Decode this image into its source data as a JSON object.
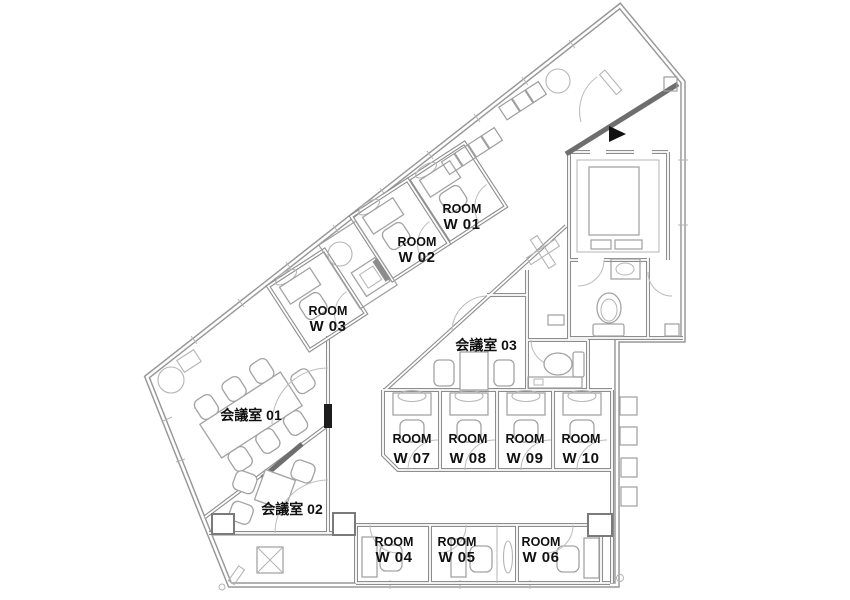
{
  "floorplan": {
    "rooms": [
      {
        "id": "W01",
        "line1": "ROOM",
        "line2": "W 01"
      },
      {
        "id": "W02",
        "line1": "ROOM",
        "line2": "W 02"
      },
      {
        "id": "W03",
        "line1": "ROOM",
        "line2": "W 03"
      },
      {
        "id": "W04",
        "line1": "ROOM",
        "line2": "W 04"
      },
      {
        "id": "W05",
        "line1": "ROOM",
        "line2": "W 05"
      },
      {
        "id": "W06",
        "line1": "ROOM",
        "line2": "W 06"
      },
      {
        "id": "W07",
        "line1": "ROOM",
        "line2": "W 07"
      },
      {
        "id": "W08",
        "line1": "ROOM",
        "line2": "W 08"
      },
      {
        "id": "W09",
        "line1": "ROOM",
        "line2": "W 09"
      },
      {
        "id": "W10",
        "line1": "ROOM",
        "line2": "W 10"
      }
    ],
    "meeting_rooms": [
      {
        "label": "会議室 01"
      },
      {
        "label": "会議室 02"
      },
      {
        "label": "会議室 03"
      }
    ],
    "colors": {
      "wall": "#979797",
      "wall_dark": "#6e6e6e",
      "furniture": "#a8a8a8",
      "text": "#111111",
      "background": "#ffffff"
    }
  }
}
